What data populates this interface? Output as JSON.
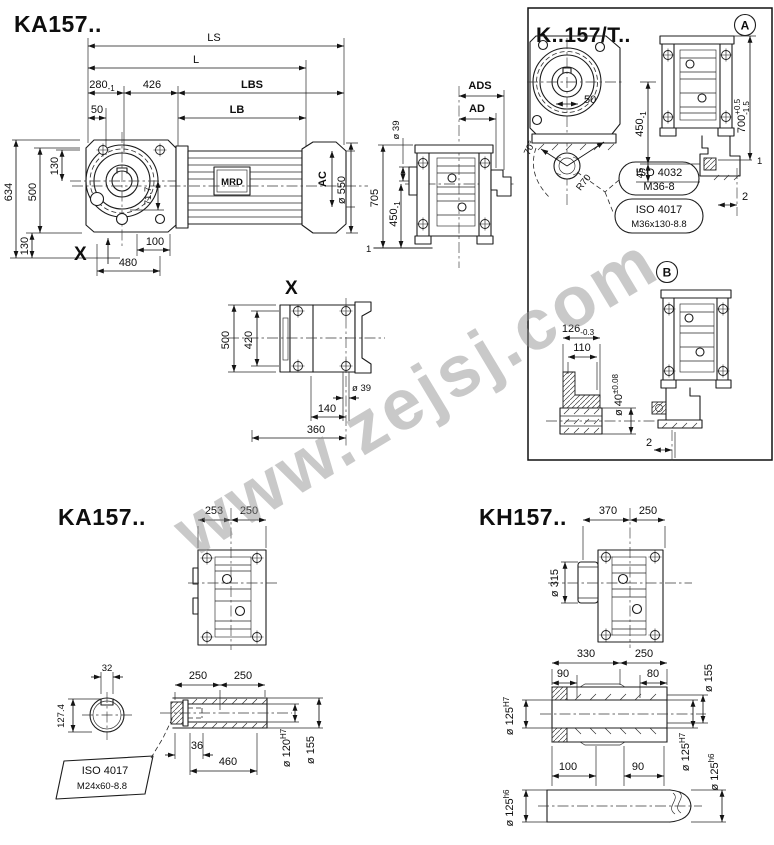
{
  "watermark": {
    "text": "www.zejsj.com"
  },
  "ka157_top": {
    "title": "KA157..",
    "motor_label": "MRD",
    "x_ref": "X",
    "LS": "LS",
    "L": "L",
    "d280": "280",
    "d280_tol": "-1",
    "d426": "426",
    "LBS": "LBS",
    "d50": "50",
    "LB": "LB",
    "d634": "634",
    "d500": "500",
    "d130_top": "130",
    "d130_bot": "130",
    "d71_7": "71.7",
    "d480": "480",
    "d100": "100",
    "AC": "AC",
    "d550": "ø 550"
  },
  "side_view": {
    "ADS": "ADS",
    "AD": "AD",
    "d39": "ø 39",
    "d705": "705",
    "d450": "450",
    "d450_tol": "-1",
    "ref1": "1"
  },
  "k157t": {
    "title": "K..157/T..",
    "badge_a": "A",
    "badge_b": "B",
    "d50": "50",
    "d70deg": "70°",
    "r70": "R70",
    "d450": "450",
    "d450_tol": "-1",
    "d45": "45",
    "d700": "700",
    "d700_tp": "+0.5",
    "d700_tm": "-1.5",
    "ref1": "1",
    "d2_a": "2",
    "c1_l1": "ISO 4032",
    "c1_l2": "M36-8",
    "c2_l1": "ISO 4017",
    "c2_l2": "M36x130-8.8",
    "d126": "126",
    "d126_tol": "-0.3",
    "d110": "110",
    "d40": "ø 40",
    "d40_tol": "±0.08",
    "d2_b": "2"
  },
  "view_x": {
    "label": "X",
    "d500": "500",
    "d420": "420",
    "d39": "ø 39",
    "d140": "140",
    "d360": "360"
  },
  "ka157_bottom": {
    "title": "KA157..",
    "d253": "253",
    "d250": "250",
    "d127": "127.4",
    "d32": "32",
    "d250a": "250",
    "d250b": "250",
    "d36": "36",
    "d460": "460",
    "d120": "ø 120",
    "d120_fit": "H7",
    "d155": "ø 155",
    "c_l1": "ISO 4017",
    "c_l2": "M24x60-8.8"
  },
  "kh157": {
    "title": "KH157..",
    "d370": "370",
    "d250": "250",
    "d315": "ø 315",
    "d330": "330",
    "d250b": "250",
    "d90a": "90",
    "d80": "80",
    "d155": "ø 155",
    "d125_l": "ø 125",
    "d125_l_fit": "H7",
    "d125_r": "ø 125",
    "d125_r_fit": "H7",
    "d125_rb": "ø 125",
    "d125_rb_fit": "h6",
    "d125_lb": "ø 125",
    "d125_lb_fit": "h6",
    "d100": "100",
    "d90b": "90"
  }
}
